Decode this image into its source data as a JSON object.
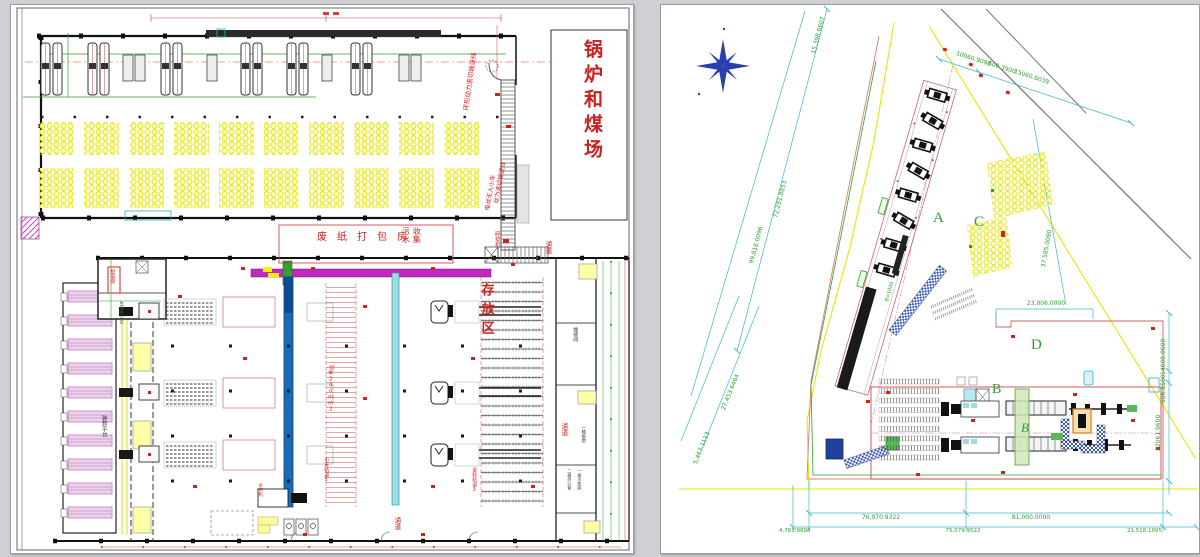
{
  "left": {
    "boiler_yard": "锅炉和煤场",
    "top_conveyor": "环形动力滚切输送线",
    "agv": "电动无人小车",
    "roller_conveyor": "动力滚切输送线",
    "pulper": "碎浆机",
    "baling_room": "废纸打包房",
    "sewage_1": "污水",
    "sewage_2": "收集",
    "storage_area": "存放区",
    "loading_platform": "装卸平台",
    "power_room": "配电房",
    "office": "生活办公区",
    "track_5": "小车轨道5",
    "track_3": "全轮轨道3",
    "cut_spec": "切Ф240mm2",
    "water_curtain": "水帘机",
    "passage": "通道",
    "room_maintenance": "维修间",
    "room_board": "一楼板房",
    "room_office2": "二楼办公室",
    "room_pump": "一楼水泵房"
  },
  "right": {
    "areas": {
      "a": "A",
      "b": "B",
      "b2": "B",
      "c": "C",
      "d": "D"
    },
    "belt_label": "B=1000",
    "dims": {
      "tl1": "15,398.6607",
      "tl2": "72,281.8853",
      "tl3": "99,818.0096",
      "t1": "10060.9098",
      "t2": "500.3900",
      "t3": "15060.6039",
      "c_yard": "37,585.0090",
      "d_width": "23,006.0000",
      "r1": "14000.0000",
      "r2": "506.6500",
      "r3": "22061.9600",
      "bl1": "27,453.6464",
      "bl2": "5,467.1113",
      "b1": "76,070.9322",
      "b2": "81,000.0000",
      "b3": "4,761.9898",
      "b4": "75,079.9522",
      "b5": "21,518.1995"
    }
  },
  "colors": {
    "wall": "#1a1a1a",
    "red_annotation": "#cc2020",
    "dim_green": "#2e9e2e",
    "dim_cyan": "#3bb8cc",
    "boundary_yellow": "#e6e600",
    "roll_yellow": "#ffffb0",
    "magenta_conveyor": "#c028c0",
    "blue_conveyor": "#1b6ab8",
    "cyan_conveyor": "#9adde0",
    "dock_purple": "#ecd2ec",
    "compass_blue": "#2a3fae",
    "orange_machine": "#e07818",
    "crane_green": "#cfe8b8"
  }
}
